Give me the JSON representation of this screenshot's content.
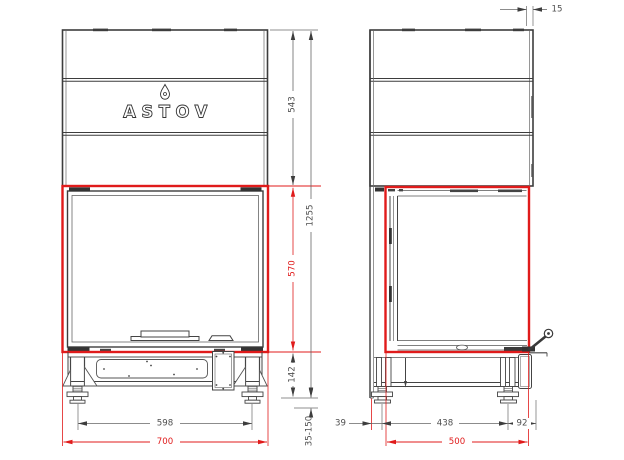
{
  "brand": "ASTOV",
  "colors": {
    "line": "#3d3d3d",
    "accent_red": "#e01b1b",
    "dimension_text": "#4f4f4f"
  },
  "front_view": {
    "dims": {
      "hood_height": "543",
      "opening_height": "570",
      "base_height": "142",
      "total_height": "1255",
      "feet_spacing": "598",
      "overall_width": "700",
      "foot_adjust_range": "35-150"
    }
  },
  "side_view": {
    "dims": {
      "top_gap": "15",
      "back_offset": "39",
      "feet_spacing": "438",
      "front_offset": "92",
      "overall_depth": "500"
    }
  }
}
